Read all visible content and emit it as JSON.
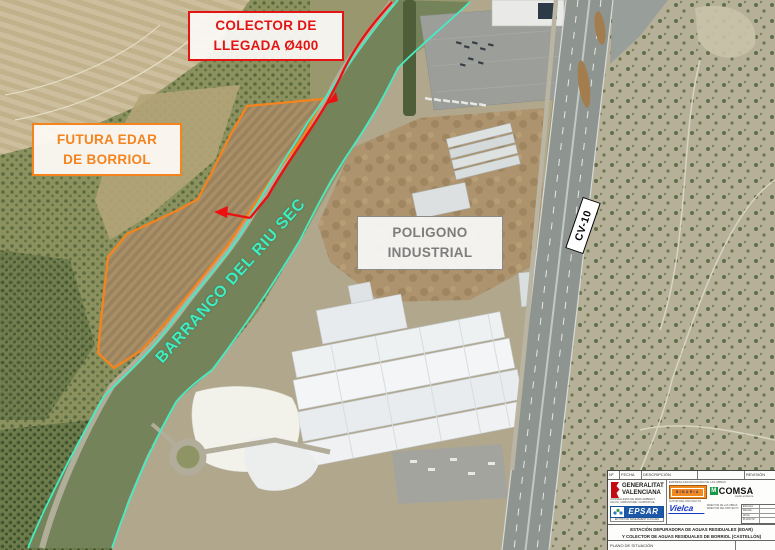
{
  "map": {
    "labels": {
      "colector": {
        "line1": "COLECTOR DE",
        "line2": "LLEGADA Ø400",
        "color": "#e31414"
      },
      "futura_edar": {
        "line1": "FUTURA EDAR",
        "line2": "DE BORRIOL",
        "color": "#f5831e"
      },
      "poligono": {
        "line1": "POLIGONO",
        "line2": "INDUSTRIAL",
        "color": "#7d7d7d"
      },
      "barranco": {
        "text": "BARRANCO DEL RIU SEC",
        "color": "#3deec2"
      },
      "road": {
        "text": "CV-10",
        "color": "#000000"
      }
    },
    "line_colors": {
      "colector_route": "#ec1111",
      "edar_site_boundary": "#f5831e",
      "riverbank": "#46ecc3"
    }
  },
  "titleblock": {
    "header": {
      "col1": "Nº",
      "col2": "FECHA",
      "col3": "DESCRIPCIÓN",
      "col4": "REVISIÓN"
    },
    "gv": {
      "name1": "GENERALITAT",
      "name2": "VALENCIANA",
      "dept1": "CONSELLERIA DE MEDI AMBIENT,",
      "dept2": "AIGUA, URBANISME I HABITATGE"
    },
    "epsar": {
      "logo": "EPSAR",
      "sub": "ENTITAT DE SANEJAMENT D'AIGÜES"
    },
    "contractor_header": "EMPRESA ADJUDICATARIA DE LAS OBRAS",
    "binaria": "BINARIA",
    "comsa": {
      "m": "M",
      "name": "COMSA",
      "sub": "medio ambiente"
    },
    "author_header": "AUTOR DEL PROYECTO",
    "vielca": "Vielca",
    "director_1": "DIRECTOR DE LAS OBRAS",
    "director_2": "DIRECTOR DEL PROYECTO",
    "side_table": [
      {
        "label": "ESCALA"
      },
      {
        "label": "FECHA"
      },
      {
        "label": "HOJA"
      },
      {
        "label": "PLANO Nº"
      }
    ],
    "project_title_1": "ESTACIÓN DEPURADORA DE AGUAS RESIDUALES (EDAR)",
    "project_title_2": "Y COLECTOR DE AGUAS RESIDUALES DE BORRIOL (CASTELLÓN)",
    "plan_title": "PLANO DE SITUACIÓN"
  }
}
